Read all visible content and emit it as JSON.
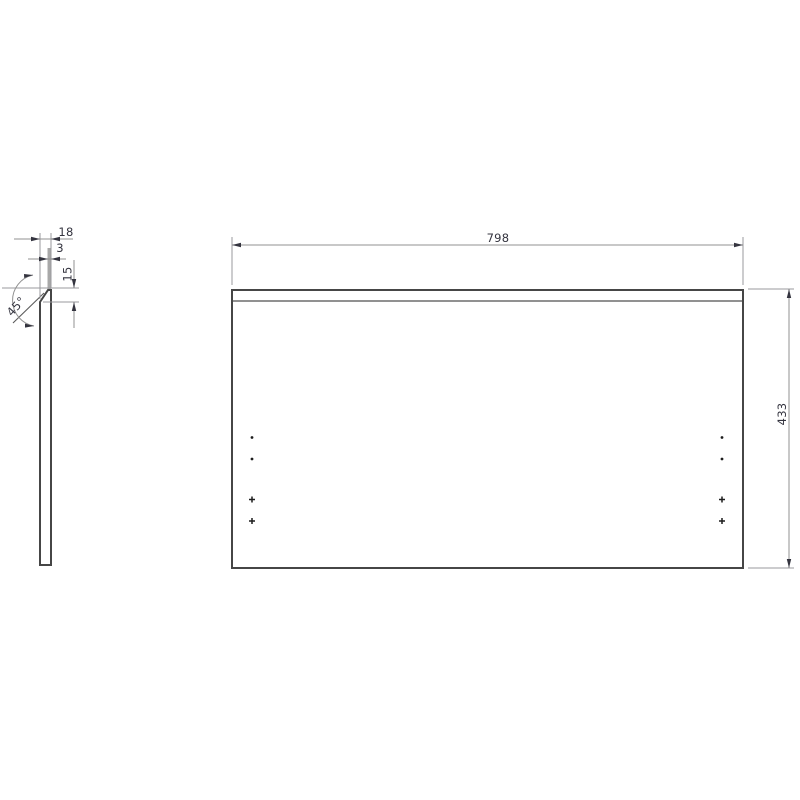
{
  "drawing": {
    "type": "technical-panel-drawing",
    "background": "#ffffff",
    "side_view": {
      "name": "panel edge profile",
      "dimensions": {
        "thickness": "18",
        "top_flat": "3",
        "chamfer_drop": "15",
        "chamfer_angle": "45°"
      }
    },
    "front_view": {
      "name": "panel front face",
      "dimensions": {
        "width": "798",
        "height": "433"
      },
      "hole_markers": {
        "left_column_count": 4,
        "right_column_count": 4,
        "styles": [
          "dot",
          "dot",
          "cross",
          "cross"
        ]
      }
    },
    "colors": {
      "outline": "#464646",
      "dimension_line": "#919191",
      "annotation_text": "#34343f",
      "highlight_bar": "#a8a8a8"
    }
  }
}
